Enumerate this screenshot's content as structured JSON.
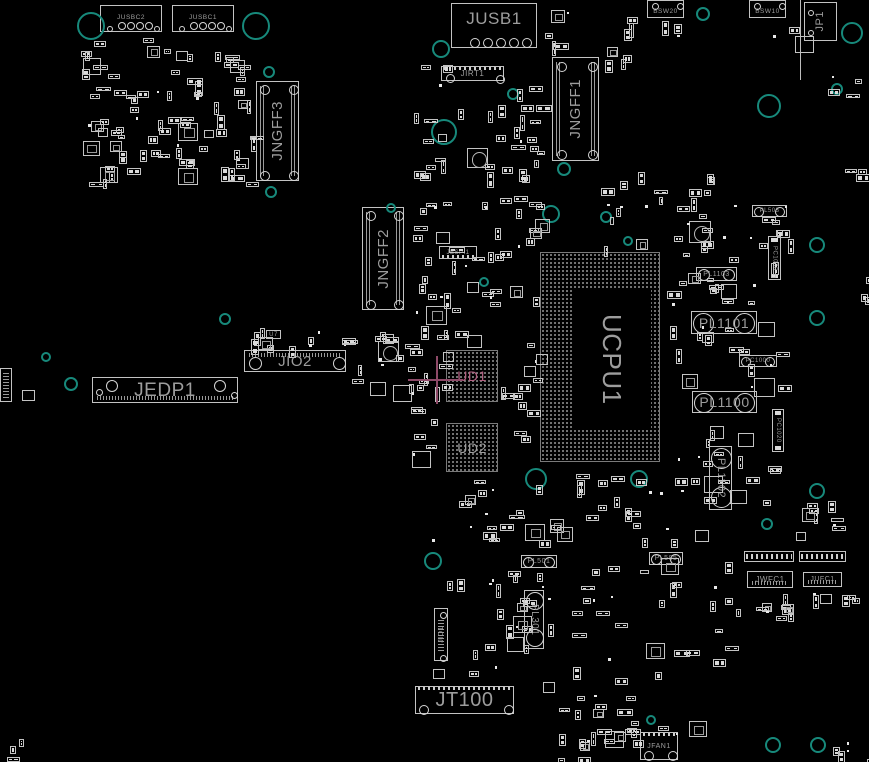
{
  "app": {
    "type": "pcb-boardview-canvas",
    "canvas": {
      "width": 869,
      "height": 762
    },
    "colors": {
      "background": "#000000",
      "component_outline": "#c3c3c3",
      "pad_fill": "#dadada",
      "label_gray": "#9d9d9d",
      "bga_dot": "#8d8d8d",
      "hole_teal": "#17897b",
      "selection_pink": "#8e4a68",
      "selected_label_pink": "#b25f80"
    }
  },
  "selection": {
    "selected_component": "UD1",
    "crosshair": {
      "cx": 437,
      "cy": 380,
      "hx1": 408,
      "hx2": 463,
      "vy1": 356,
      "vy2": 404
    }
  },
  "components": [
    {
      "id": "jusbc2",
      "label": "JUSBC2",
      "x": 100,
      "y": 5,
      "w": 62,
      "h": 27,
      "ls": 6.5,
      "ldir": "h",
      "box": true,
      "circles": [
        [
          20,
          19,
          3
        ],
        [
          29,
          19,
          3
        ],
        [
          38,
          19,
          3
        ],
        [
          47,
          19,
          3
        ],
        [
          8,
          22,
          2
        ],
        [
          55,
          22,
          2
        ]
      ]
    },
    {
      "id": "jusbc1",
      "label": "JUSBC1",
      "x": 172,
      "y": 5,
      "w": 62,
      "h": 27,
      "ls": 6.5,
      "ldir": "h",
      "box": true,
      "circles": [
        [
          20,
          19,
          3
        ],
        [
          29,
          19,
          3
        ],
        [
          38,
          19,
          3
        ],
        [
          47,
          19,
          3
        ],
        [
          8,
          22,
          2
        ],
        [
          55,
          22,
          2
        ]
      ]
    },
    {
      "id": "jusb1",
      "label": "JUSB1",
      "x": 451,
      "y": 3,
      "w": 86,
      "h": 45,
      "ls": 17,
      "ldir": "h",
      "box": true,
      "labelpos": "top",
      "circles": [
        [
          22,
          38,
          4
        ],
        [
          35,
          38,
          4
        ],
        [
          48,
          38,
          4
        ],
        [
          61,
          38,
          4
        ],
        [
          74,
          38,
          4
        ]
      ],
      "teeth": "none"
    },
    {
      "id": "jp1",
      "label": "JP1",
      "x": 804,
      "y": 2,
      "w": 33,
      "h": 39,
      "ls": 11,
      "ldir": "v-up",
      "box": true,
      "circles": [
        [
          5,
          9,
          2
        ],
        [
          5,
          29,
          2
        ]
      ]
    },
    {
      "id": "bsw20",
      "label": "BSW20",
      "x": 647,
      "y": 0,
      "w": 37,
      "h": 18,
      "ls": 6.5,
      "ldir": "h",
      "box": true,
      "labelpos": "bottom",
      "circles": [
        [
          6,
          4,
          2.5
        ],
        [
          31,
          4,
          2.5
        ]
      ]
    },
    {
      "id": "bsw10",
      "label": "BSW10",
      "x": 749,
      "y": 0,
      "w": 37,
      "h": 18,
      "ls": 6.5,
      "ldir": "h",
      "box": true,
      "labelpos": "bottom",
      "circles": [
        [
          6,
          4,
          2.5
        ],
        [
          31,
          4,
          2.5
        ]
      ]
    },
    {
      "id": "jirt1",
      "label": "JIRT1",
      "x": 441,
      "y": 66,
      "w": 63,
      "h": 15,
      "ls": 8,
      "ldir": "h",
      "box": true,
      "teeth": "top",
      "circles": [
        [
          7,
          10,
          3.5
        ],
        [
          57,
          11,
          3.5
        ]
      ]
    },
    {
      "id": "jngff3",
      "label": "JNGFF3",
      "x": 256,
      "y": 81,
      "w": 43,
      "h": 100,
      "ls": 15,
      "ldir": "v-up",
      "box": true,
      "hatch": "sides",
      "circles": [
        [
          7,
          7,
          4
        ],
        [
          36,
          7,
          4
        ],
        [
          7,
          93,
          4
        ],
        [
          36,
          93,
          4
        ]
      ]
    },
    {
      "id": "jngff1",
      "label": "JNGFF1",
      "x": 552,
      "y": 57,
      "w": 47,
      "h": 104,
      "ls": 15,
      "ldir": "v-up",
      "box": true,
      "hatch": "sides",
      "circles": [
        [
          8,
          8,
          4
        ],
        [
          39,
          8,
          4
        ],
        [
          8,
          96,
          4
        ],
        [
          39,
          96,
          4
        ]
      ]
    },
    {
      "id": "jngff2",
      "label": "JNGFF2",
      "x": 362,
      "y": 207,
      "w": 42,
      "h": 103,
      "ls": 15,
      "ldir": "v-up",
      "box": true,
      "hatch": "sides",
      "circles": [
        [
          7,
          7,
          4
        ],
        [
          35,
          7,
          4
        ],
        [
          7,
          96,
          4
        ],
        [
          35,
          96,
          4
        ]
      ]
    },
    {
      "id": "jespi1",
      "label": "JESPI1",
      "x": 439,
      "y": 246,
      "w": 38,
      "h": 13,
      "ls": 6,
      "ldir": "h",
      "box": true,
      "teeth": "bottom"
    },
    {
      "id": "u7",
      "label": "U7",
      "x": 266,
      "y": 330,
      "w": 15,
      "h": 9,
      "ls": 6,
      "ldir": "h",
      "box": true
    },
    {
      "id": "jio2",
      "label": "JIO2",
      "x": 244,
      "y": 350,
      "w": 102,
      "h": 22,
      "ls": 15,
      "ldir": "h",
      "box": true,
      "hatch": "top",
      "circles": [
        [
          9,
          11,
          5.5
        ],
        [
          93,
          11,
          5.5
        ]
      ]
    },
    {
      "id": "jedp1",
      "label": "JEDP1",
      "x": 92,
      "y": 377,
      "w": 146,
      "h": 26,
      "ls": 19,
      "ldir": "h",
      "box": true,
      "hatch": "bottom",
      "circles": [
        [
          18,
          7,
          5
        ],
        [
          126,
          7,
          5
        ],
        [
          5,
          13,
          2.5
        ],
        [
          140,
          16,
          2.5
        ]
      ]
    },
    {
      "id": "ud1",
      "label": "UD1",
      "x": 446,
      "y": 350,
      "w": 52,
      "h": 52,
      "ls": 14,
      "ldir": "h",
      "grid": true,
      "highlight": true
    },
    {
      "id": "ud2",
      "label": "UD2",
      "x": 446,
      "y": 423,
      "w": 52,
      "h": 49,
      "ls": 14,
      "ldir": "h",
      "grid": true
    },
    {
      "id": "ucpu1",
      "label": "UCPU1",
      "x": 540,
      "y": 252,
      "w": 120,
      "h": 210,
      "ls": 26,
      "ldir": "v-down",
      "grid": true,
      "inner": {
        "left": 32,
        "top": 36,
        "w": 78,
        "h": 140
      }
    },
    {
      "id": "pl503",
      "label": "PL503",
      "x": 752,
      "y": 205,
      "w": 35,
      "h": 12,
      "ls": 6,
      "ldir": "h",
      "pill": "h"
    },
    {
      "id": "pc1030",
      "label": "PC1030",
      "x": 768,
      "y": 236,
      "w": 13,
      "h": 44,
      "ls": 6,
      "ldir": "v-down",
      "box": true,
      "caps": "v"
    },
    {
      "id": "pl1103",
      "label": "PL1103",
      "x": 696,
      "y": 267,
      "w": 41,
      "h": 14,
      "ls": 7,
      "ldir": "h",
      "pill": "h"
    },
    {
      "id": "pl1101",
      "label": "PL1101",
      "x": 691,
      "y": 311,
      "w": 66,
      "h": 23,
      "ls": 14,
      "ldir": "h",
      "pill": "h"
    },
    {
      "id": "pc1000",
      "label": "PC1000",
      "x": 739,
      "y": 355,
      "w": 38,
      "h": 12,
      "ls": 6,
      "ldir": "h",
      "pill": "h"
    },
    {
      "id": "pl1100",
      "label": "PL1100",
      "x": 692,
      "y": 391,
      "w": 65,
      "h": 22,
      "ls": 14,
      "ldir": "h",
      "pill": "h"
    },
    {
      "id": "pc1020",
      "label": "PC1020",
      "x": 772,
      "y": 409,
      "w": 12,
      "h": 43,
      "ls": 6,
      "ldir": "v-down",
      "box": true,
      "caps": "v"
    },
    {
      "id": "pl1102",
      "label": "PL1102",
      "x": 709,
      "y": 446,
      "w": 23,
      "h": 64,
      "ls": 11,
      "ldir": "v-down",
      "pill": "v"
    },
    {
      "id": "pl501",
      "label": "PL501",
      "x": 521,
      "y": 555,
      "w": 36,
      "h": 13,
      "ls": 7,
      "ldir": "h",
      "pill": "h"
    },
    {
      "id": "pl505",
      "label": "PL505",
      "x": 649,
      "y": 552,
      "w": 34,
      "h": 13,
      "ls": 7,
      "ldir": "h",
      "pill": "h"
    },
    {
      "id": "pl301",
      "label": "PL301",
      "x": 524,
      "y": 590,
      "w": 20,
      "h": 59,
      "ls": 10,
      "ldir": "v-down",
      "pill": "v"
    },
    {
      "id": "jio1",
      "label": "JIO1",
      "x": 434,
      "y": 608,
      "w": 14,
      "h": 53,
      "ls": 7,
      "ldir": "v-up",
      "box": true,
      "hatch": "mid-v",
      "circles": [
        [
          7,
          5,
          2.5
        ],
        [
          7,
          48,
          2.5
        ]
      ]
    },
    {
      "id": "jwfc1",
      "label": "JWFC1",
      "x": 747,
      "y": 571,
      "w": 46,
      "h": 17,
      "ls": 8,
      "ldir": "h",
      "box": true,
      "hatch": "bottom"
    },
    {
      "id": "jufc1",
      "label": "JUFC1",
      "x": 803,
      "y": 572,
      "w": 39,
      "h": 15,
      "ls": 7,
      "ldir": "h",
      "box": true,
      "hatch": "bottom"
    },
    {
      "id": "jt100",
      "label": "JT100",
      "x": 415,
      "y": 686,
      "w": 99,
      "h": 28,
      "ls": 20,
      "ldir": "h",
      "box": true,
      "teeth": "top",
      "circles": [
        [
          7,
          22,
          4
        ],
        [
          92,
          22,
          4
        ]
      ]
    },
    {
      "id": "jfan1",
      "label": "JFAN1",
      "x": 640,
      "y": 732,
      "w": 38,
      "h": 28,
      "ls": 7,
      "ldir": "h",
      "box": true,
      "teeth": "top",
      "circles": [
        [
          7,
          22,
          4
        ],
        [
          31,
          22,
          4
        ]
      ]
    }
  ],
  "extras": [
    {
      "type": "edge-line",
      "x": 800,
      "y": 0,
      "w": 1,
      "h": 80
    },
    {
      "type": "vconn",
      "x": 0,
      "y": 368,
      "w": 12,
      "h": 34
    },
    {
      "type": "box",
      "x": 22,
      "y": 390,
      "w": 13,
      "h": 11
    },
    {
      "type": "pinrow",
      "x": 744,
      "y": 551,
      "w": 50,
      "h": 11
    },
    {
      "type": "pinrow",
      "x": 799,
      "y": 551,
      "w": 47,
      "h": 11
    },
    {
      "type": "qfn",
      "x": 689,
      "y": 221,
      "w": 22,
      "h": 22
    },
    {
      "type": "qfn",
      "x": 467,
      "y": 148,
      "w": 21,
      "h": 20
    },
    {
      "type": "qfn",
      "x": 378,
      "y": 341,
      "w": 21,
      "h": 21
    }
  ],
  "holes": [
    [
      90,
      25,
      13
    ],
    [
      255,
      25,
      13
    ],
    [
      702,
      13,
      6
    ],
    [
      851,
      32,
      10
    ],
    [
      768,
      105,
      11
    ],
    [
      836,
      88,
      5
    ],
    [
      440,
      48,
      8
    ],
    [
      443,
      131,
      12
    ],
    [
      512,
      93,
      5
    ],
    [
      268,
      71,
      5
    ],
    [
      270,
      191,
      5
    ],
    [
      563,
      168,
      6
    ],
    [
      390,
      207,
      4
    ],
    [
      550,
      213,
      8
    ],
    [
      605,
      216,
      5
    ],
    [
      627,
      240,
      4
    ],
    [
      816,
      244,
      7
    ],
    [
      483,
      281,
      4
    ],
    [
      224,
      318,
      5
    ],
    [
      816,
      317,
      7
    ],
    [
      45,
      356,
      4
    ],
    [
      70,
      383,
      6
    ],
    [
      535,
      478,
      10
    ],
    [
      638,
      478,
      8
    ],
    [
      816,
      490,
      7
    ],
    [
      766,
      523,
      5
    ],
    [
      432,
      560,
      8
    ],
    [
      650,
      719,
      4
    ],
    [
      772,
      744,
      7
    ],
    [
      817,
      744,
      7
    ]
  ],
  "clusters": [
    {
      "x": 80,
      "y": 36,
      "w": 172,
      "h": 148,
      "n": 85,
      "seed": 1
    },
    {
      "x": 410,
      "y": 52,
      "w": 38,
      "h": 160,
      "n": 16,
      "seed": 2
    },
    {
      "x": 455,
      "y": 85,
      "w": 85,
      "h": 128,
      "n": 26,
      "seed": 3
    },
    {
      "x": 545,
      "y": 2,
      "w": 95,
      "h": 58,
      "n": 12,
      "seed": 4
    },
    {
      "x": 600,
      "y": 170,
      "w": 110,
      "h": 78,
      "n": 22,
      "seed": 5
    },
    {
      "x": 478,
      "y": 198,
      "w": 60,
      "h": 112,
      "n": 18,
      "seed": 6
    },
    {
      "x": 408,
      "y": 220,
      "w": 68,
      "h": 122,
      "n": 20,
      "seed": 7
    },
    {
      "x": 500,
      "y": 312,
      "w": 38,
      "h": 148,
      "n": 13,
      "seed": 8
    },
    {
      "x": 408,
      "y": 300,
      "w": 36,
      "h": 98,
      "n": 10,
      "seed": 9
    },
    {
      "x": 408,
      "y": 404,
      "w": 36,
      "h": 72,
      "n": 7,
      "seed": 10
    },
    {
      "x": 430,
      "y": 474,
      "w": 288,
      "h": 68,
      "n": 42,
      "seed": 11
    },
    {
      "x": 660,
      "y": 196,
      "w": 130,
      "h": 142,
      "n": 36,
      "seed": 12
    },
    {
      "x": 662,
      "y": 345,
      "w": 118,
      "h": 158,
      "n": 26,
      "seed": 13
    },
    {
      "x": 430,
      "y": 548,
      "w": 298,
      "h": 134,
      "n": 56,
      "seed": 14
    },
    {
      "x": 557,
      "y": 688,
      "w": 78,
      "h": 58,
      "n": 14,
      "seed": 15
    },
    {
      "x": 735,
      "y": 592,
      "w": 125,
      "h": 28,
      "n": 16,
      "seed": 16
    },
    {
      "x": 250,
      "y": 327,
      "w": 158,
      "h": 21,
      "n": 15,
      "seed": 17
    },
    {
      "x": 350,
      "y": 330,
      "w": 68,
      "h": 58,
      "n": 12,
      "seed": 18
    },
    {
      "x": 795,
      "y": 495,
      "w": 63,
      "h": 43,
      "n": 9,
      "seed": 19
    },
    {
      "x": 825,
      "y": 735,
      "w": 44,
      "h": 25,
      "n": 5,
      "seed": 20
    },
    {
      "x": 556,
      "y": 735,
      "w": 78,
      "h": 24,
      "n": 7,
      "seed": 21
    },
    {
      "x": 820,
      "y": 75,
      "w": 38,
      "h": 24,
      "n": 4,
      "seed": 22
    },
    {
      "x": 660,
      "y": 20,
      "w": 38,
      "h": 18,
      "n": 3,
      "seed": 23
    },
    {
      "x": 765,
      "y": 20,
      "w": 38,
      "h": 18,
      "n": 3,
      "seed": 24
    },
    {
      "x": 845,
      "y": 155,
      "w": 24,
      "h": 20,
      "n": 3,
      "seed": 25
    },
    {
      "x": 855,
      "y": 275,
      "w": 14,
      "h": 30,
      "n": 3,
      "seed": 26
    },
    {
      "x": 0,
      "y": 738,
      "w": 22,
      "h": 22,
      "n": 3,
      "seed": 27
    },
    {
      "x": 625,
      "y": 720,
      "w": 75,
      "h": 15,
      "n": 6,
      "seed": 28
    }
  ]
}
